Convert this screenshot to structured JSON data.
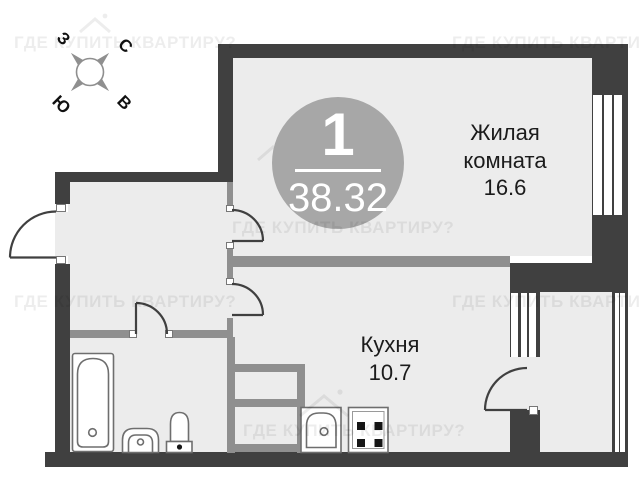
{
  "plan": {
    "badge": {
      "number": "1",
      "total_area": "38.32"
    },
    "rooms": {
      "living": {
        "name_line1": "Жилая",
        "name_line2": "комната",
        "area": "16.6"
      },
      "kitchen": {
        "name": "Кухня",
        "area": "10.7"
      }
    },
    "compass": {
      "north": "С",
      "south": "Ю",
      "west": "З",
      "east": "В"
    },
    "watermark": "ГДЕ КУПИТЬ КВАРТИРУ?",
    "colors": {
      "wall": "#404040",
      "partition": "#8f8f8f",
      "floor": "#ececec",
      "badge_bg": "#a7a7a7",
      "fixture_stroke": "#6e6e6e",
      "label_text": "#1b1b1b"
    }
  }
}
